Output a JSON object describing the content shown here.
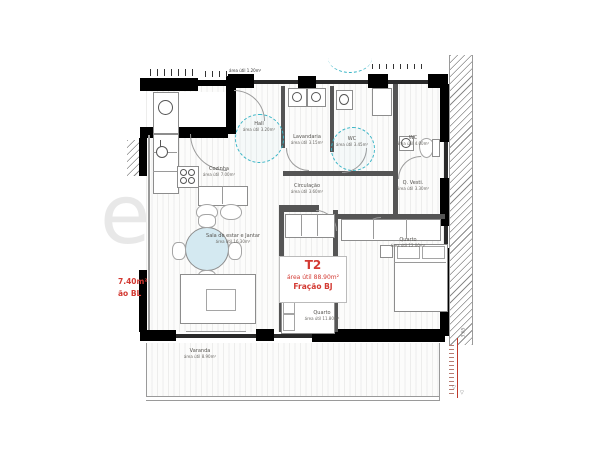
{
  "unit": {
    "type": "T2",
    "area": "área útil 88.90m²",
    "fraction": "Fração BJ"
  },
  "neighbor": {
    "area": "7.40m²",
    "fraction": "ão BL"
  },
  "rooms": [
    {
      "name": "Hall",
      "area": "área útil 3.20m²"
    },
    {
      "name": "Lavandaria",
      "area": "área útil 3.15m²"
    },
    {
      "name": "WC",
      "area": "área útil 3.45m²"
    },
    {
      "name": "WC",
      "area": "área útil 4.00m²"
    },
    {
      "name": "Q. Vesti.",
      "area": "área útil 3.30m²"
    },
    {
      "name": "Circulação",
      "area": "área útil 3.60m²"
    },
    {
      "name": "Cozinha",
      "area": "área útil 7.00m²"
    },
    {
      "name": "Sala de estar e Jantar",
      "area": "área útil 16.30m²"
    },
    {
      "name": "Quarto",
      "area": "área útil 11.80m²"
    },
    {
      "name": "Quarto",
      "area": "área útil 12.00m²"
    },
    {
      "name": "Varanda",
      "area": "área útil 8.90m²"
    }
  ],
  "watermark": {
    "text": "ezone"
  },
  "dimension": {
    "value": "3.65",
    "level_mark": "▽"
  },
  "misc": {
    "top_small": "área útil 1.20m²"
  },
  "colors": {
    "wall": "#000000",
    "accent_teal": "#3ab5c6",
    "accent_red": "#d33a33",
    "floor_line": "#e8e8e6"
  }
}
